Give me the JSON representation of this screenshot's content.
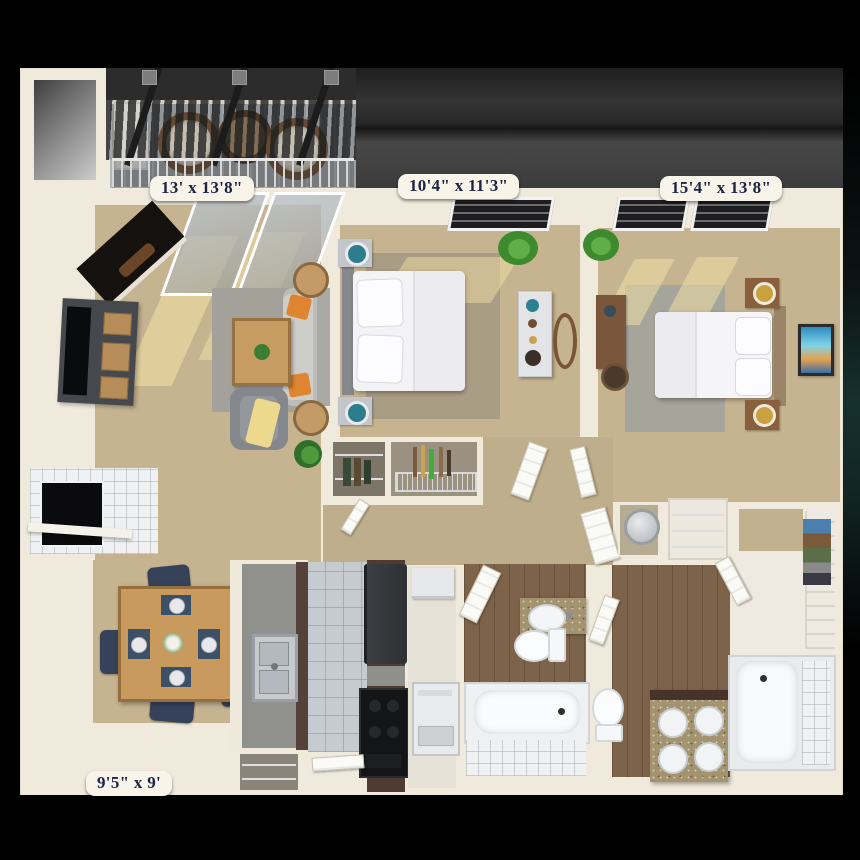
{
  "floorplan": {
    "room_labels": {
      "living_room": "13' x 13'8\"",
      "bedroom_small": "10'4\" x 11'3\"",
      "bedroom_large": "15'4\" x 13'8\"",
      "dining_area": "9'5\" x 9'"
    },
    "colors": {
      "render_background": "#000000",
      "wall_cream": "#F0EADD",
      "carpet_tan": "#C6B491",
      "rug_gray": "#A3A199",
      "kitchen_tile": "#C6CBD0",
      "wood_floor": "#7C6349",
      "granite_counter": "#A3936F",
      "cabinet_brown": "#54413A",
      "pergola_gray": "#2C2C2C",
      "accent_orange": "#DF8430",
      "dining_chair_navy": "#36425A",
      "label_text": "#1D2342",
      "label_background": "#F8F4EA"
    }
  }
}
